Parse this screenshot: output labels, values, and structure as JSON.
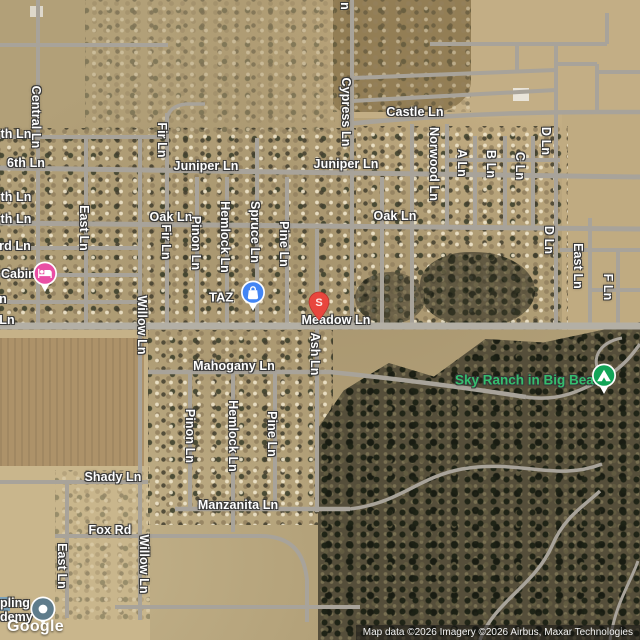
{
  "branding": {
    "logo": "Google",
    "attribution": "Map data ©2026 Imagery ©2026 Airbus, Maxar Technologies"
  },
  "colors": {
    "road": "#a8a39a",
    "major_road": "#b3afa5",
    "marker_blue": "#4285f4",
    "marker_red": "#e8463d",
    "marker_pink": "#e94fa4",
    "marker_green": "#12a558",
    "marker_gray": "#5f7c8b",
    "poi_green_text": "#35bd6e"
  },
  "pois": {
    "cabin": {
      "label": "Cabin",
      "type": "lodging"
    },
    "taz": {
      "label": "TAZ",
      "type": "shopping"
    },
    "s_pin": {
      "letter": "S"
    },
    "sky_ranch": {
      "label": "Sky Ranch in Big Bear",
      "type": "campground"
    },
    "academy": {
      "line1": "pling",
      "line2": "demy"
    }
  },
  "labels_h": [
    {
      "t": "Castle Ln",
      "x": 415,
      "y": 112
    },
    {
      "t": "Juniper Ln",
      "x": 206,
      "y": 166
    },
    {
      "t": "Juniper Ln",
      "x": 346,
      "y": 164
    },
    {
      "t": "Oak Ln",
      "x": 171,
      "y": 217
    },
    {
      "t": "Oak Ln",
      "x": 395,
      "y": 216
    },
    {
      "t": "Meadow Ln",
      "x": 336,
      "y": 320
    },
    {
      "t": "Mahogany Ln",
      "x": 234,
      "y": 366
    },
    {
      "t": "Manzanita Ln",
      "x": 238,
      "y": 505
    },
    {
      "t": "Shady Ln",
      "x": 113,
      "y": 477
    },
    {
      "t": "Fox Rd",
      "x": 110,
      "y": 530
    },
    {
      "t": "6th Ln",
      "x": 26,
      "y": 163
    },
    {
      "t": "th Ln",
      "x": 16,
      "y": 134
    },
    {
      "t": "th Ln",
      "x": 16,
      "y": 197
    },
    {
      "t": "th Ln",
      "x": 16,
      "y": 219
    },
    {
      "t": "rd Ln",
      "x": 15,
      "y": 246
    },
    {
      "t": "n",
      "x": 3,
      "y": 299
    },
    {
      "t": "Ln",
      "x": 7,
      "y": 320
    }
  ],
  "labels_v": [
    {
      "t": "Central Ln",
      "x": 36,
      "y": 117
    },
    {
      "t": "Cypress Ln",
      "x": 346,
      "y": 112
    },
    {
      "t": "n",
      "x": 345,
      "y": 6
    },
    {
      "t": "Fir Ln",
      "x": 162,
      "y": 140
    },
    {
      "t": "East Ln",
      "x": 84,
      "y": 228
    },
    {
      "t": "Fir Ln",
      "x": 166,
      "y": 242
    },
    {
      "t": "Pinon Ln",
      "x": 196,
      "y": 243
    },
    {
      "t": "Hemlock Ln",
      "x": 225,
      "y": 237
    },
    {
      "t": "Spruce Ln",
      "x": 255,
      "y": 232
    },
    {
      "t": "Pine Ln",
      "x": 284,
      "y": 244
    },
    {
      "t": "Willow Ln",
      "x": 142,
      "y": 325
    },
    {
      "t": "Ash Ln",
      "x": 315,
      "y": 354
    },
    {
      "t": "Norwood Ln",
      "x": 434,
      "y": 164
    },
    {
      "t": "A Ln",
      "x": 462,
      "y": 163
    },
    {
      "t": "B Ln",
      "x": 491,
      "y": 164
    },
    {
      "t": "C Ln",
      "x": 520,
      "y": 166
    },
    {
      "t": "D Ln",
      "x": 546,
      "y": 141
    },
    {
      "t": "D Ln",
      "x": 549,
      "y": 240
    },
    {
      "t": "East Ln",
      "x": 578,
      "y": 266
    },
    {
      "t": "F Ln",
      "x": 608,
      "y": 287
    },
    {
      "t": "Pinon Ln",
      "x": 190,
      "y": 436
    },
    {
      "t": "Hemlock Ln",
      "x": 233,
      "y": 436
    },
    {
      "t": "Pine Ln",
      "x": 272,
      "y": 434
    },
    {
      "t": "Willow Ln",
      "x": 144,
      "y": 564
    },
    {
      "t": "East Ln",
      "x": 62,
      "y": 566
    }
  ]
}
